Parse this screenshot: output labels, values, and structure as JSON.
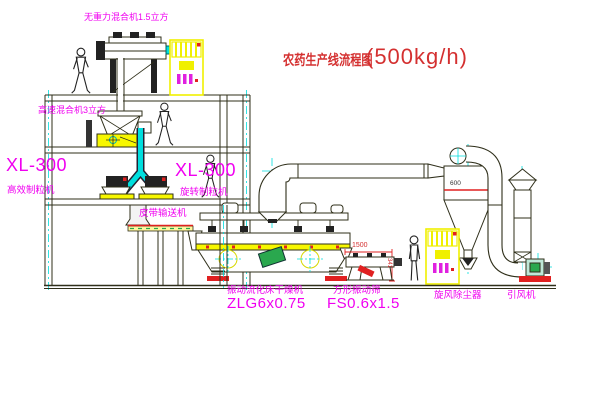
{
  "title": {
    "text": "农药生产线流程图",
    "capacity": "(500kg/h)"
  },
  "equipment_labels": {
    "top_mixer": "无重力混合机1.5立方",
    "cone_mixer": "高速混合机3立方",
    "granulator_left_model": "XL-300",
    "granulator_left_name": "高效制粒机",
    "granulator_right_model": "XL-300",
    "granulator_right_name": "旋转制粒机",
    "belt_conveyor": "皮带输送机",
    "dryer_name": "振动流化床干燥机",
    "dryer_model": "ZLG6x0.75",
    "sieve_name": "方形振动筛",
    "sieve_model": "FS0.6x1.5",
    "cyclone": "旋风除尘器",
    "fan": "引风机"
  },
  "dimensions": {
    "cyclone_diameter": "600",
    "sieve_length": "1500",
    "sieve_height": "341"
  },
  "colors": {
    "background": "#ffffff",
    "line": "#2f2f1a",
    "machine_yellow": "#f7f700",
    "centerline_cyan": "#00dede",
    "label_magenta": "#f000f0",
    "accent_red": "#e02020",
    "accent_green": "#2aa84e",
    "title_red": "#d43030"
  }
}
